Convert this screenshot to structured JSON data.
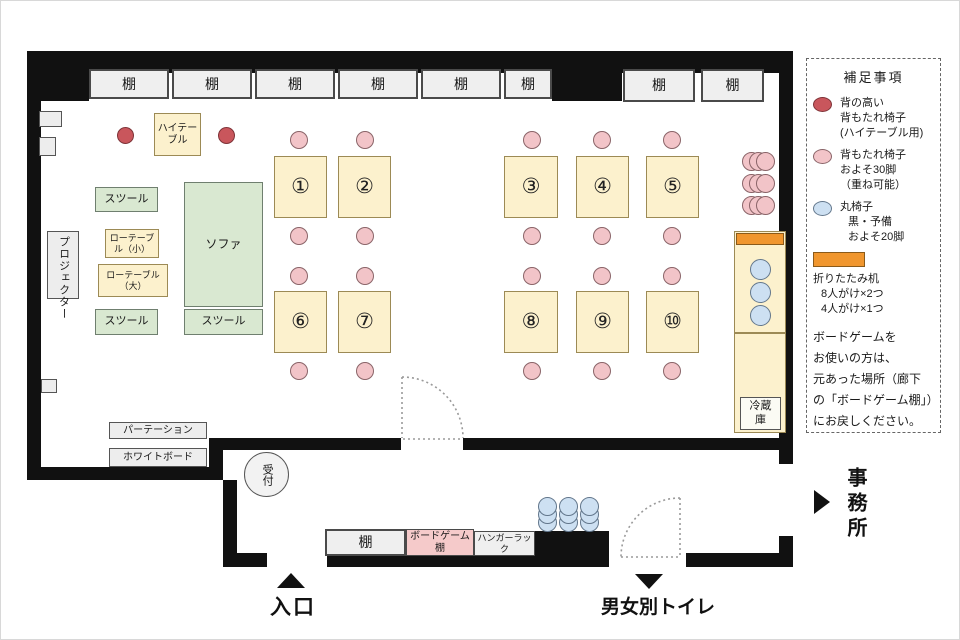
{
  "colors": {
    "wall": "#111111",
    "table_fill": "#fcf1cd",
    "green_fill": "#d9e8d1",
    "pink_chair": "#f2c4c8",
    "red_chair": "#c9565c",
    "blue_chair": "#cde0f2",
    "orange_desk": "#f0962e",
    "shelf_fill": "#efefef",
    "board_game_shelf_fill": "#f5caca"
  },
  "shelves_top": [
    "棚",
    "棚",
    "棚",
    "棚",
    "棚",
    "棚",
    "棚",
    "棚"
  ],
  "fixtures": {
    "projector": "プロジェクター",
    "high_table": "ハイテーブル",
    "stool_top": "スツール",
    "low_table_small": "ローテーブル（小）",
    "low_table_large": "ローテーブル（大）",
    "sofa": "ソファ",
    "stool_bottom_left": "スツール",
    "stool_bottom_right": "スツール",
    "partition": "パーテーション",
    "whiteboard": "ホワイトボード",
    "reception": "受付",
    "fridge": "冷蔵庫",
    "shelf_bottom": "棚",
    "board_game_shelf": "ボードゲーム棚",
    "hanger_rack": "ハンガーラック"
  },
  "tables": [
    "①",
    "②",
    "③",
    "④",
    "⑤",
    "⑥",
    "⑦",
    "⑧",
    "⑨",
    "⑩"
  ],
  "exits": {
    "entrance": "入口",
    "toilet": "男女別トイレ",
    "office": "事務所"
  },
  "legend": {
    "title": "補足事項",
    "items": [
      {
        "icon": "tall-back-chair",
        "lines": [
          "背の高い",
          "背もたれ椅子",
          "(ハイテーブル用)"
        ]
      },
      {
        "icon": "back-chair",
        "lines": [
          "背もたれ椅子",
          "およそ30脚",
          "（重ね可能）"
        ]
      },
      {
        "icon": "round-stool",
        "lines": [
          "丸椅子",
          "黒・予備",
          "およそ20脚"
        ]
      },
      {
        "icon": "folding-desk",
        "lines": [
          "折りたたみ机",
          "8人がけ×2つ",
          "4人がけ×1つ"
        ]
      }
    ],
    "note": [
      "ボードゲームを",
      "お使いの方は、",
      "元あった場所（廊下",
      "の「ボードゲーム棚」）",
      "にお戻しください。"
    ]
  }
}
